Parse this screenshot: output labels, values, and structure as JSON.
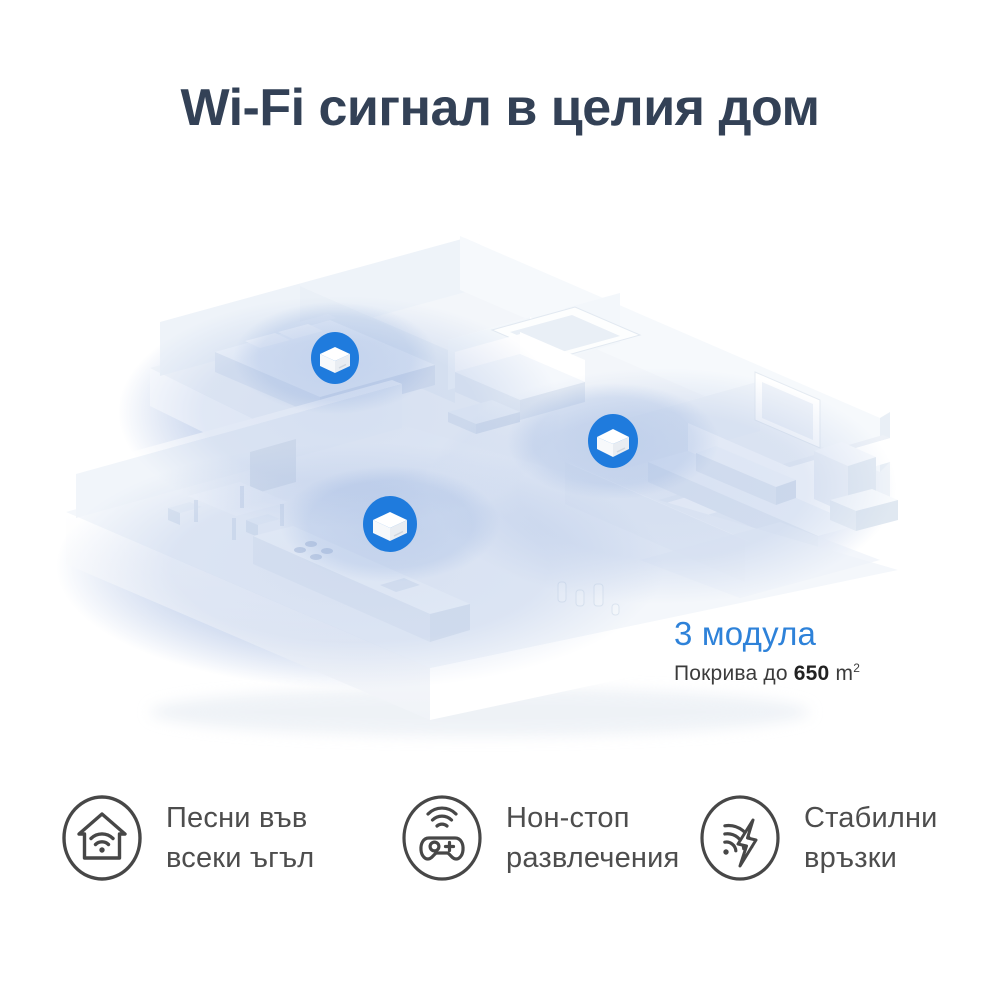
{
  "title": "Wi-Fi сигнал в целия дом",
  "coverage": {
    "modules_label": "3 модула",
    "area_prefix": "Покрива до",
    "area_value": "650",
    "area_unit": "m",
    "area_superscript": "2"
  },
  "features": [
    {
      "icon": "home-wifi-icon",
      "line1": "Песни във",
      "line2": "всеки ъгъл"
    },
    {
      "icon": "gamepad-wifi-icon",
      "line1": "Нон-стоп",
      "line2": "развлечения"
    },
    {
      "icon": "wifi-lightning-icon",
      "line1": "Стабилни",
      "line2": "връзки"
    }
  ],
  "illustration": {
    "mesh_device_count": "3"
  },
  "colors": {
    "accent_blue": "#1f7bdd",
    "modules_text_blue": "#2e82d9",
    "title_color": "#334156",
    "body_text": "#4d4d4d",
    "coverage_glow": "#9fb6e0",
    "icon_stroke": "#474747"
  }
}
